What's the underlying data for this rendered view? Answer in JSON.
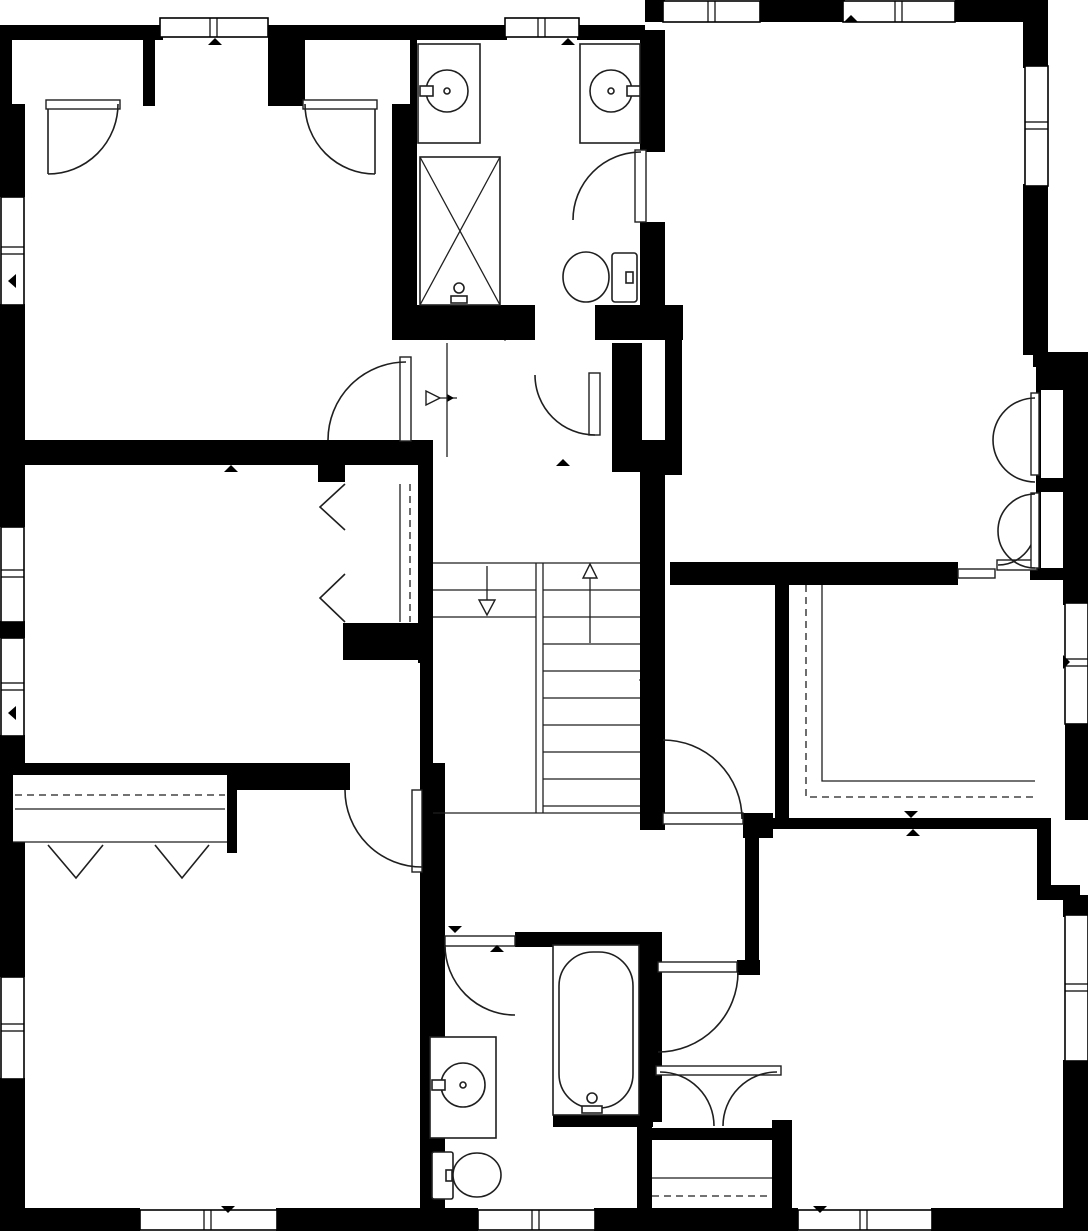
{
  "watermark": "CR MLS",
  "colors": {
    "wall": "#000000",
    "line": "#1f1f1f",
    "label": "#111111",
    "watermark": "#d9d9d9",
    "bg": "#ffffff"
  },
  "rooms": {
    "bedroom_top_left": {
      "name": "BEDROOM",
      "dims": "12'11\" x 13'5\""
    },
    "bath_top": {
      "name": "BATH",
      "dims": "7'2\" x 8'8\""
    },
    "primary_bedroom": {
      "name": "PRIMARY BEDROOM",
      "dims": "12'5\" x 17'11\""
    },
    "hall_vestibule": {
      "name": "HALL",
      "dims": "4'8\" x 3'7\""
    },
    "bedroom_mid_left": {
      "name": "BEDROOM",
      "dims": "13'4\" x 9'9\""
    },
    "hall_corridor": {
      "name": "HALL",
      "dims": "4'0\" x 8'0\""
    },
    "wic": {
      "name": "W.I.C.",
      "dims": "9'3\" x 7'8\""
    },
    "hall_main": {
      "name": "HALL",
      "dims": "10'2\" x 15'4\""
    },
    "bedroom_bottom_left": {
      "name": "BEDROOM",
      "dims": "13'4\" x 14'4\""
    },
    "bath_bottom": {
      "name": "BATH",
      "dims": "6'7\" x 8'10\""
    },
    "bedroom_bottom_right": {
      "name": "BEDROOM",
      "dims": "13'9\" x 12'8\""
    }
  }
}
